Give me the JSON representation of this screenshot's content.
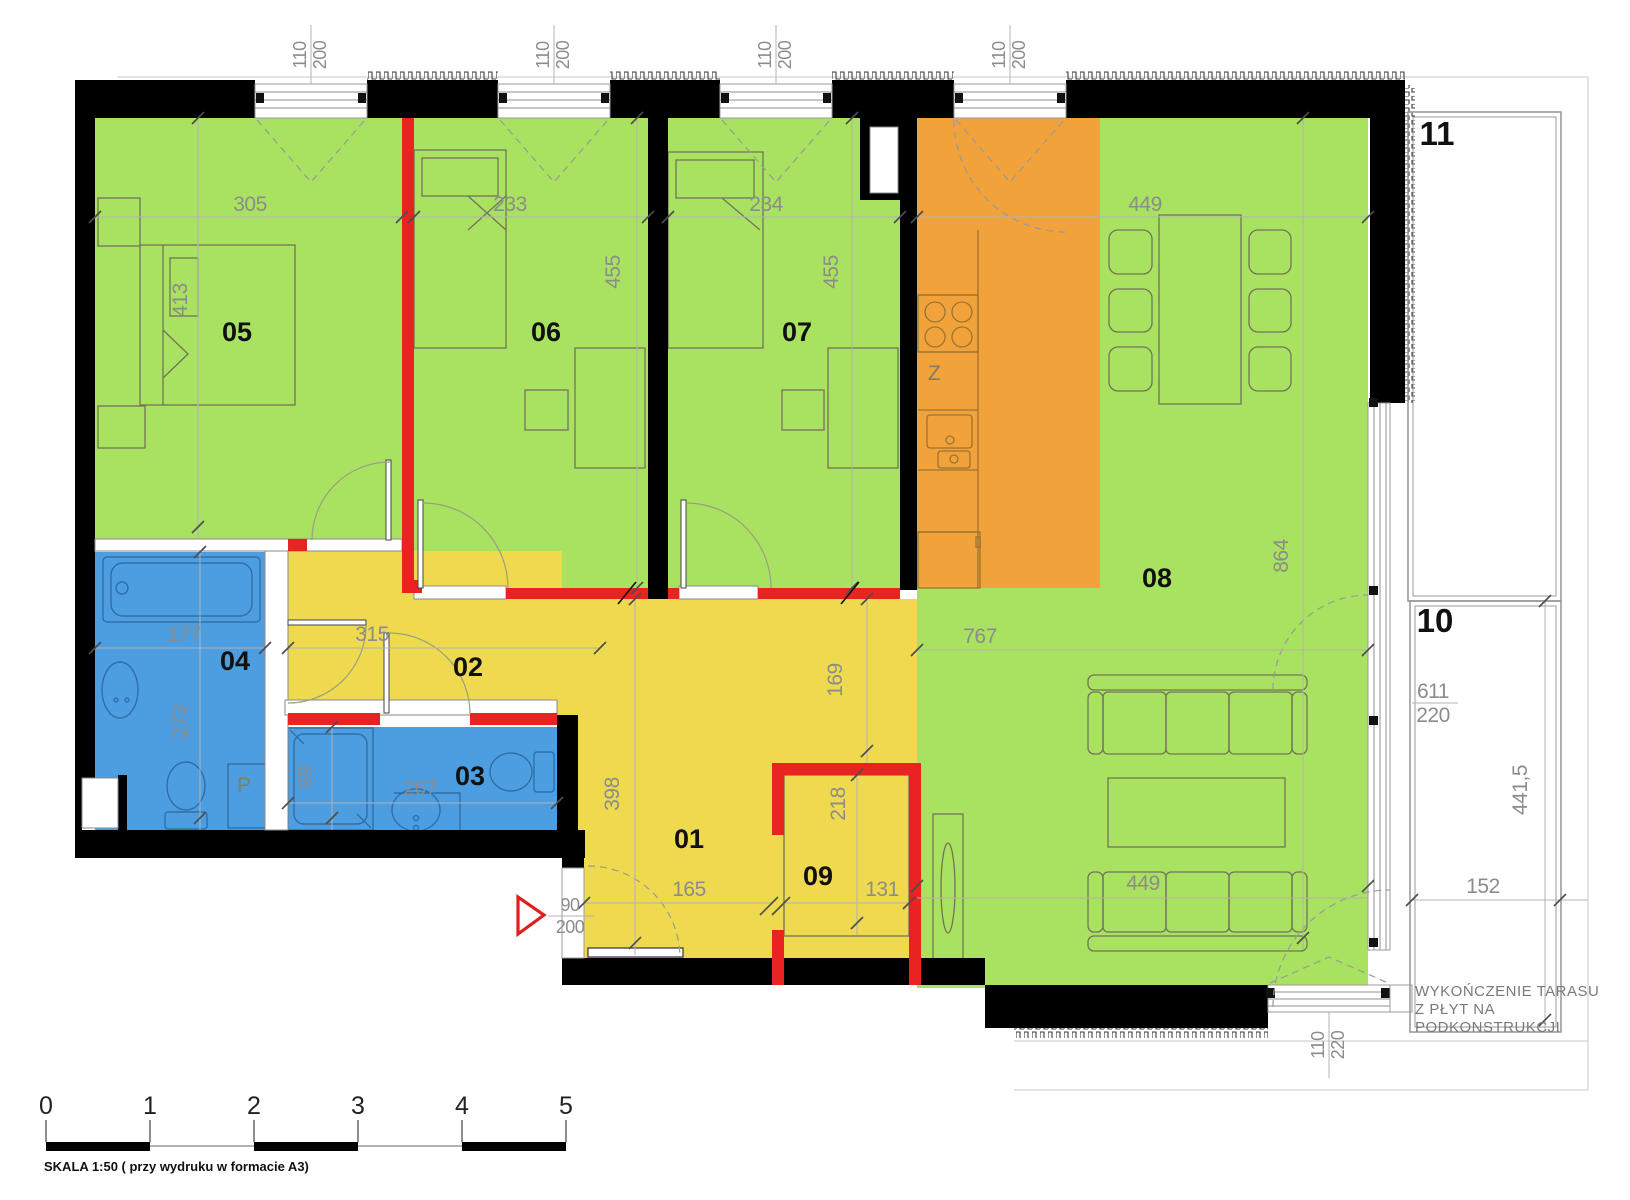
{
  "document": {
    "type": "apartment-floor-plan"
  },
  "colors": {
    "room_green": "#a9e160",
    "hall_yellow": "#eed94f",
    "kitchen_orange": "#f2a23b",
    "bathroom_blue": "#4d9ee0",
    "partition_red": "#e82322",
    "wall_black": "#000000",
    "dimension_gray": "#8c8c8c"
  },
  "rooms": {
    "r01": {
      "number": "01",
      "dim_width": "165",
      "dim_height": "398"
    },
    "r02": {
      "number": "02",
      "dim_width": "315"
    },
    "r03": {
      "number": "03",
      "dim_width": "267",
      "dim_height": "99"
    },
    "r04": {
      "number": "04",
      "dim_width": "177",
      "dim_height": "273"
    },
    "r05": {
      "number": "05",
      "dim_width": "305",
      "dim_height": "413"
    },
    "r06": {
      "number": "06",
      "dim_width": "233",
      "dim_height": "455"
    },
    "r07": {
      "number": "07",
      "dim_width": "234",
      "dim_height": "455"
    },
    "r08": {
      "number": "08",
      "dim_width_top": "449",
      "dim_width_mid": "767",
      "dim_width_bottom": "449",
      "dim_height": "864",
      "dim_hall": "169"
    },
    "r09": {
      "number": "09",
      "dim_width": "131",
      "dim_height": "218"
    }
  },
  "terraces": {
    "t10": {
      "number": "10",
      "dim_width": "152",
      "dim_height": "441,5",
      "door_width": "611",
      "door_height": "220"
    },
    "t11": {
      "number": "11"
    }
  },
  "openings": {
    "top_window": {
      "width": "110",
      "height": "200"
    },
    "balcony_door": {
      "width": "110",
      "height": "220"
    },
    "entrance_door": {
      "width": "90",
      "height": "200"
    }
  },
  "fixtures": {
    "kitchen_sink": "Z",
    "washing_machine": "P"
  },
  "terrace_note": {
    "line1": "WYKOŃCZENIE TARASU",
    "line2": "Z PŁYT NA",
    "line3": "PODKONSTRUKCJI"
  },
  "scale_bar": {
    "t0": "0",
    "t1": "1",
    "t2": "2",
    "t3": "3",
    "t4": "4",
    "t5": "5",
    "caption": "SKALA 1:50 ( przy wydruku w formacie A3)"
  }
}
